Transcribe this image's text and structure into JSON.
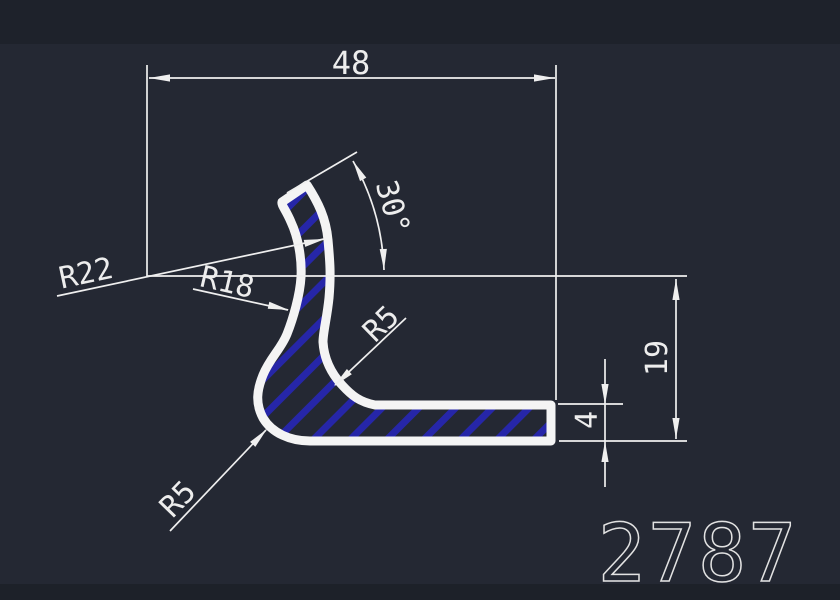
{
  "app": {
    "viewport_background": "#242833",
    "top_strip_color": "#1e222b",
    "bottom_strip_color": "#1d2129"
  },
  "drawing": {
    "part_number": "2787",
    "colors": {
      "outline": "#f4f4f4",
      "hatch": "#2626a8",
      "dimension_lines": "#efefef",
      "text": "#ededed"
    },
    "dimensions": {
      "overall_width": "48",
      "overall_height": "19",
      "base_thickness": "4",
      "arm_angle": "30°",
      "radius_wall_inner": "R22",
      "radius_wall_outer": "R18",
      "radius_inner_fillet": "R5",
      "radius_outer_fillet": "R5"
    }
  }
}
